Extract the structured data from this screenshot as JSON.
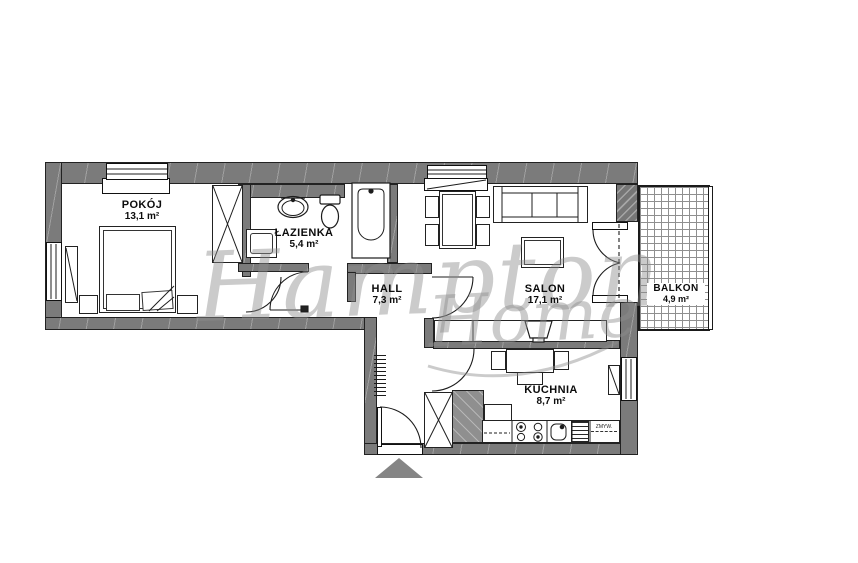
{
  "watermark": {
    "brand_line1": "Hampton",
    "brand_line2": "Home"
  },
  "rooms": [
    {
      "id": "pokoj",
      "name": "POKÓJ",
      "area": "13,1 m²"
    },
    {
      "id": "lazienka",
      "name": "ŁAZIENKA",
      "area": "5,4 m²"
    },
    {
      "id": "hall",
      "name": "HALL",
      "area": "7,3 m²"
    },
    {
      "id": "salon",
      "name": "SALON",
      "area": "17,1 m²"
    },
    {
      "id": "kuchnia",
      "name": "KUCHNIA",
      "area": "8,7 m²"
    },
    {
      "id": "balkon",
      "name": "BALKON",
      "area": "4,9 m²"
    }
  ],
  "labels": {
    "dishwasher": "ZMYW."
  },
  "colors": {
    "wall": "#7b7b7b",
    "line": "#1c1c1c",
    "watermark": "#8d8d8d",
    "entry_arrow": "#858585"
  }
}
